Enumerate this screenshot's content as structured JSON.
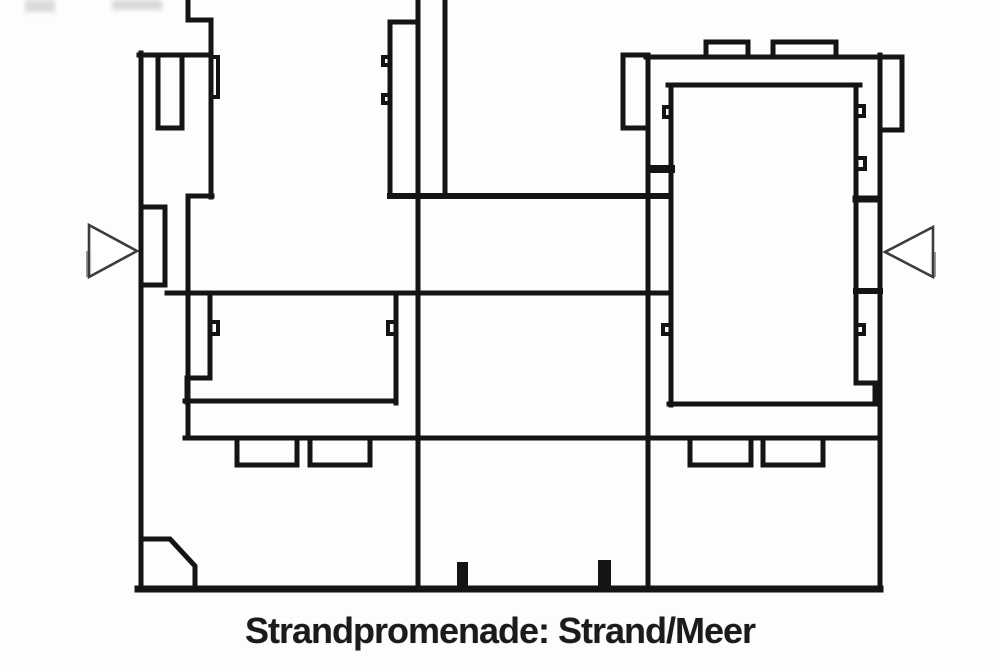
{
  "caption": {
    "text": "Strandpromenade: Strand/Meer"
  },
  "plan": {
    "background": "#fdfdfd",
    "wall_color": "#141414",
    "arrow_outline": "#3c3c3c",
    "arrow_accent": "#9a9a9a",
    "smudge_color": "#bdbdbd",
    "walls": [
      {
        "name": "outer-wall-left",
        "d": "M 141 53 V 590",
        "w": 5
      },
      {
        "name": "wall-top-left",
        "d": "M 139 55 H 211",
        "w": 5
      },
      {
        "name": "wall-west-outline",
        "d": "M 188 0 V 20 H 211 V 197",
        "w": 5
      },
      {
        "name": "wall-west-notch",
        "d": "M 211 57 H 218 V 97 H 211",
        "w": 4
      },
      {
        "name": "wall-west-inner",
        "d": "M 212 196 H 188 V 438",
        "w": 5
      },
      {
        "name": "shaft-box-left",
        "d": "M 158 55 V 128 H 182 V 55",
        "w": 5
      },
      {
        "name": "entrance-tab-left",
        "d": "M 141 207 H 165 V 285 H 141",
        "w": 5
      },
      {
        "name": "chamfer-corner",
        "d": "M 145 539 H 170 L 195 566 V 588",
        "w": 5
      },
      {
        "name": "wall-east-jog",
        "d": "M 390 22 H 415",
        "w": 5
      },
      {
        "name": "wall-east",
        "d": "M 390 22 V 196",
        "w": 5
      },
      {
        "name": "wall-east-notch-1",
        "d": "M 390 57 H 383 V 65 H 390",
        "w": 4
      },
      {
        "name": "wall-east-notch-2",
        "d": "M 390 95 H 383 V 103 H 390",
        "w": 4
      },
      {
        "name": "wall-middle",
        "d": "M 418 0 V 590",
        "w": 5
      },
      {
        "name": "wall-corridor",
        "d": "M 445 0 V 193",
        "w": 5
      },
      {
        "name": "courtyard-left-west-wall",
        "d": "M 210 293 V 378 H 187 V 402",
        "w": 5
      },
      {
        "name": "courtyard-left-west-notch",
        "d": "M 210 322 H 218 V 334 H 210",
        "w": 4
      },
      {
        "name": "courtyard-left-bottom",
        "d": "M 185 401 H 396",
        "w": 5
      },
      {
        "name": "courtyard-left-east-wall",
        "d": "M 396 403 V 293",
        "w": 5
      },
      {
        "name": "courtyard-left-east-notch",
        "d": "M 396 322 H 388 V 334 H 396",
        "w": 4
      },
      {
        "name": "wall-horizontal-upper",
        "d": "M 390 196 H 670",
        "w": 6
      },
      {
        "name": "wall-horizontal-middle",
        "d": "M 167 293 H 671",
        "w": 5
      },
      {
        "name": "wall-horizontal-lower",
        "d": "M 185 438 H 880",
        "w": 5
      },
      {
        "name": "wall-bottom",
        "d": "M 138 589 H 880",
        "w": 7
      },
      {
        "name": "right-outer-wall-west",
        "d": "M 648 55 V 590",
        "w": 5
      },
      {
        "name": "right-top-wall",
        "d": "M 646 57 H 880",
        "w": 5
      },
      {
        "name": "castellation-1",
        "d": "M 706 57 V 42 H 748 V 57",
        "w": 5
      },
      {
        "name": "castellation-2",
        "d": "M 773 57 V 42 H 836 V 57",
        "w": 5
      },
      {
        "name": "right-outer-wall-east",
        "d": "M 880 55 V 590",
        "w": 5
      },
      {
        "name": "pilaster-left",
        "d": "M 647 55 H 623 V 128 H 647",
        "w": 5
      },
      {
        "name": "pilaster-right",
        "d": "M 880 57 H 902 V 130 H 880",
        "w": 5
      },
      {
        "name": "courtyard-right-top",
        "d": "M 668 85 H 860",
        "w": 5
      },
      {
        "name": "courtyard-right-west-wall",
        "d": "M 671 85 V 405",
        "w": 5
      },
      {
        "name": "courtyard-right-west-notch-1",
        "d": "M 671 107 H 664 V 117 H 671",
        "w": 4
      },
      {
        "name": "courtyard-right-west-stub",
        "d": "M 650 169 H 671",
        "w": 8
      },
      {
        "name": "courtyard-right-west-notch-2",
        "d": "M 671 325 H 663 V 334 H 671",
        "w": 4
      },
      {
        "name": "courtyard-right-east-wall",
        "d": "M 856 85 V 383 H 875 V 403",
        "w": 5
      },
      {
        "name": "courtyard-right-east-notch-1",
        "d": "M 856 106 H 864 V 116 H 856",
        "w": 4
      },
      {
        "name": "courtyard-right-east-notch-2",
        "d": "M 856 158 H 865 V 169 H 856",
        "w": 4
      },
      {
        "name": "courtyard-right-east-stub-1",
        "d": "M 856 199 H 876",
        "w": 7
      },
      {
        "name": "courtyard-right-east-stub-2",
        "d": "M 856 291 H 880",
        "w": 6
      },
      {
        "name": "courtyard-right-east-notch-3",
        "d": "M 856 325 H 864 V 334 H 856",
        "w": 4
      },
      {
        "name": "courtyard-right-bottom",
        "d": "M 669 404 H 875",
        "w": 5
      },
      {
        "name": "balcony-outline-1",
        "d": "M 237 438 V 465 H 297 V 438",
        "w": 5
      },
      {
        "name": "balcony-outline-2",
        "d": "M 310 438 V 465 H 370 V 438",
        "w": 5
      },
      {
        "name": "balcony-outline-3",
        "d": "M 690 438 V 465 H 751 V 438",
        "w": 5
      },
      {
        "name": "balcony-outline-4",
        "d": "M 763 438 V 465 H 823 V 438",
        "w": 5
      }
    ],
    "solids": [
      {
        "name": "door-tick-1",
        "x": 457,
        "y": 562,
        "w": 11,
        "h": 26
      },
      {
        "name": "door-tick-2",
        "x": 598,
        "y": 560,
        "w": 13,
        "h": 27
      }
    ],
    "arrows": [
      {
        "name": "entrance-arrow-left",
        "points": "89,225 137,251 89,277",
        "accent": "M 89 251 V 277"
      },
      {
        "name": "entrance-arrow-right",
        "points": "933,227 885,252 933,277",
        "accent": "M 933 252 V 277"
      }
    ],
    "smudges": [
      {
        "name": "scan-artifact-1",
        "x": 25,
        "y": 0,
        "w": 30,
        "h": 12
      },
      {
        "name": "scan-artifact-2",
        "x": 112,
        "y": 0,
        "w": 50,
        "h": 10
      }
    ]
  }
}
